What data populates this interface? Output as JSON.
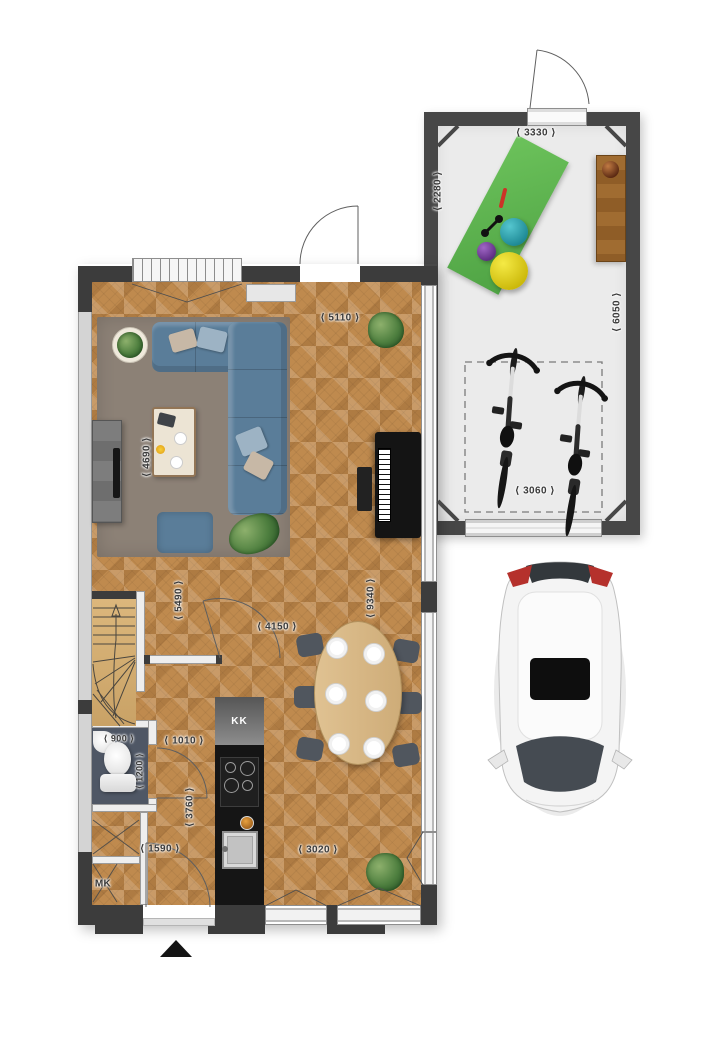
{
  "plan": {
    "house": {
      "labels": {
        "kitchen_unit": "KK",
        "meter_cupboard": "MK"
      },
      "dimensions": {
        "living_width": "⟨ 5110 ⟩",
        "living_depth": "⟨ 4690 ⟩",
        "stair_hall_depth": "⟨ 5490 ⟩",
        "open_plan_length": "⟨ 9340 ⟩",
        "dining_width": "⟨ 4150 ⟩",
        "toilet_width": "⟨ 900 ⟩",
        "toilet_depth": "⟨ 1200 ⟩",
        "hall_width": "⟨ 1010 ⟩",
        "kitchen_wall_length": "⟨ 3760 ⟩",
        "entrance_zone_width": "⟨ 1590 ⟩",
        "kitchen_zone_width": "⟨ 3020 ⟩"
      }
    },
    "garage": {
      "dimensions": {
        "width_top": "⟨ 3330 ⟩",
        "front_zone_depth": "⟨ 2280 ⟩",
        "length": "⟨ 6050 ⟩",
        "door_zone_width": "⟨ 3060 ⟩"
      }
    },
    "colors": {
      "wall": "#3c3c3c",
      "garage_wall": "#474747",
      "wood_floor": "#bf8a4e",
      "rug": "#8c8176",
      "sofa": "#5a7d99",
      "toilet_floor": "#4f5765",
      "gym_mat": "#5eb254",
      "ball_teal": "#2fa8b5",
      "ball_purple": "#7b3fa0",
      "ball_yellow": "#e8d41f",
      "car_taillight": "#b5312c",
      "dimension_text": "#3a3a3a"
    }
  }
}
